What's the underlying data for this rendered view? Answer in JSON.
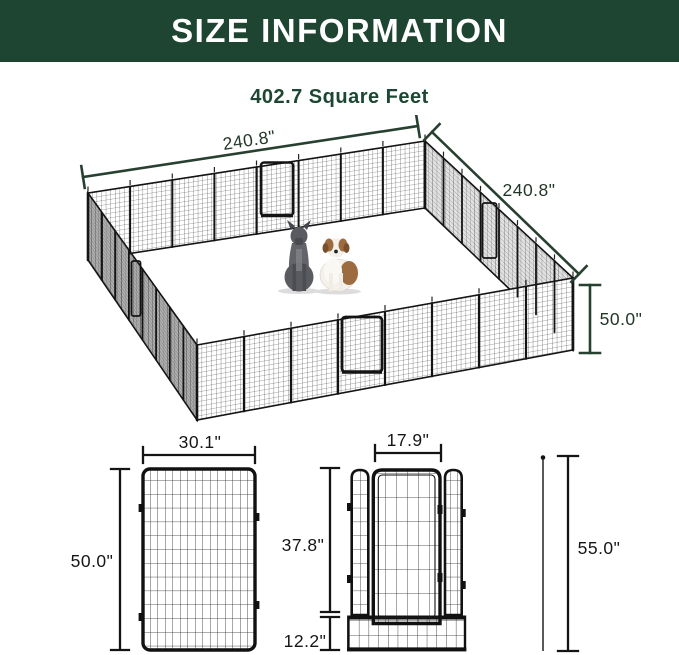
{
  "header": {
    "title": "SIZE INFORMATION"
  },
  "subtitle": {
    "text": "402.7 Square Feet"
  },
  "overview_diagram": {
    "left_width_label": "240.8\"",
    "right_width_label": "240.8\"",
    "height_label": "50.0\""
  },
  "single_panel_diagram": {
    "width_label": "30.1\"",
    "height_label": "50.0\""
  },
  "door_panel_diagram": {
    "door_width_label": "17.9\"",
    "door_height_label": "37.8\"",
    "bottom_section_height_label": "12.2\"",
    "stake_total_height_label": "55.0\""
  },
  "colors": {
    "header_background": "#1e4432",
    "header_text": "#ffffff",
    "subtitle_text": "#1d4733",
    "overview_dimension_color": "#27402f",
    "detail_dimension_color": "#141414"
  }
}
